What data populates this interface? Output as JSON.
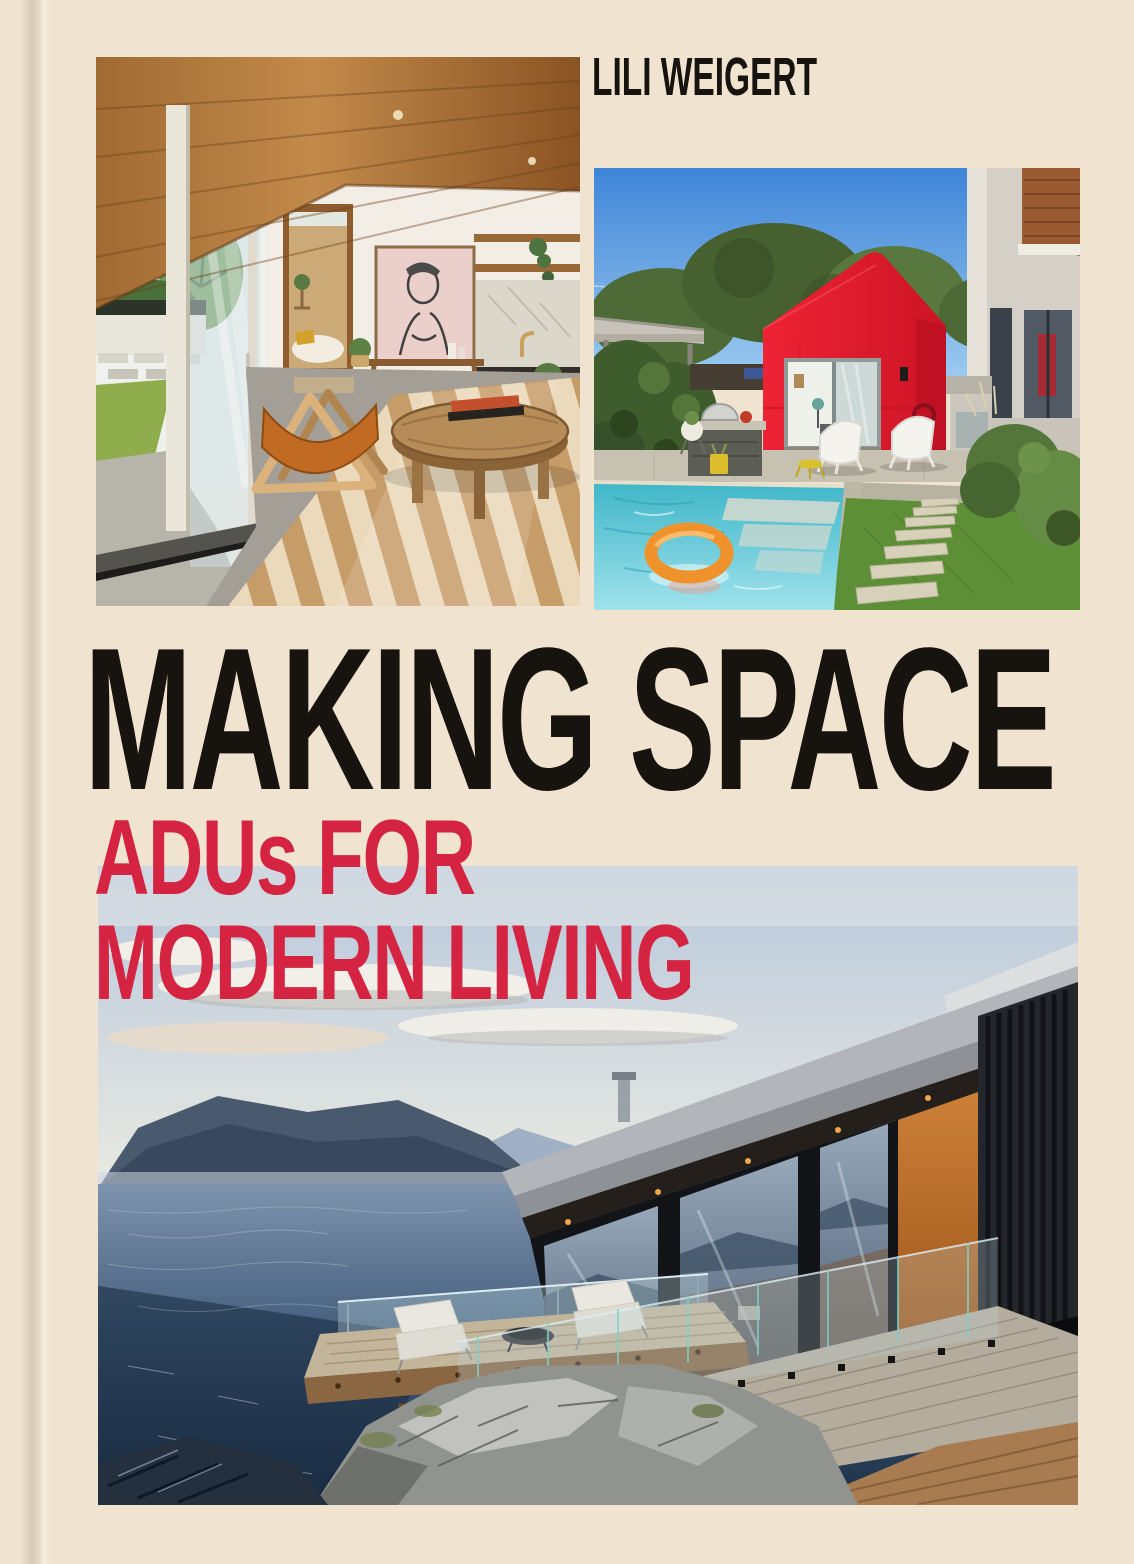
{
  "cover": {
    "author": "LILI WEIGERT",
    "title": "MAKING SPACE",
    "subtitle_line1": "ADUs FOR",
    "subtitle_line2": "MODERN LIVING"
  },
  "photos": [
    {
      "name": "interior-living-room",
      "alt": "Mid-century interior with diagonal wood-plank ceiling, glass sliding doors, tan leather sling chair, round rustic coffee table, chevron rug, pink framed sketch and wood kitchen"
    },
    {
      "name": "backyard-red-adu",
      "alt": "Backyard with bright red gabled ADU, open glass door, white chairs, outdoor kitchen island, pergola, hedge, pool with orange ring float and lawn with paver steps"
    },
    {
      "name": "waterfront-container-adu",
      "alt": "Dark modern container home with long glass wall, orange panel, glass railing and cantilevered wood deck with lounge chairs over rocky ocean shore at dusk"
    }
  ],
  "colors": {
    "background": "#f0e4d0",
    "title_ink": "#17130e",
    "accent_red": "#d52441"
  }
}
